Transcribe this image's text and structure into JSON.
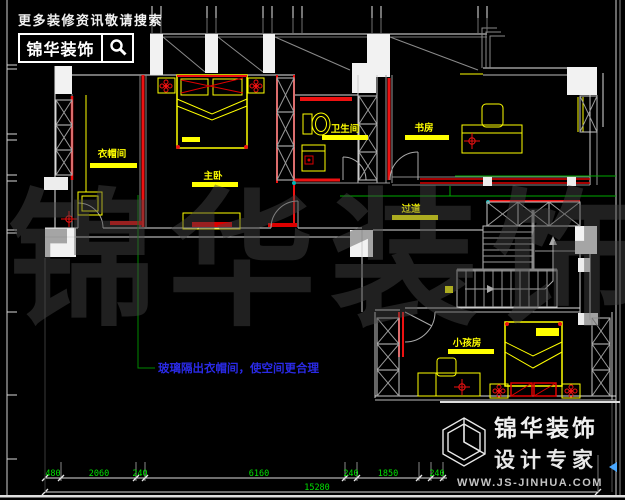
{
  "header": {
    "promo": "更多装修资讯敬请搜索",
    "logo": "锦华装饰"
  },
  "plan": {
    "rooms": [
      {
        "id": "cloakroom",
        "label": "衣帽间"
      },
      {
        "id": "master-bedroom",
        "label": "主卧"
      },
      {
        "id": "bathroom",
        "label": "卫生间"
      },
      {
        "id": "study",
        "label": "书房"
      },
      {
        "id": "corridor",
        "label": "过道"
      },
      {
        "id": "kids-room",
        "label": "小孩房"
      }
    ],
    "annotation": {
      "text": "玻璃隔出衣帽间，使空间更合理"
    }
  },
  "dimensions": {
    "segments": [
      "480",
      "2060",
      "240",
      "6160",
      "240",
      "1850",
      "240"
    ],
    "total": "15280"
  },
  "title_block": {
    "company": "锦华装饰",
    "tagline": "设计专家",
    "website": "WWW.JS-JINHUA.COM"
  },
  "watermark": {
    "chars": [
      "锦",
      "华",
      "装",
      "饰"
    ]
  },
  "colors": {
    "wall_red": "#ee1111",
    "furniture_yellow": "#ffff00",
    "dimension_green": "#00e000",
    "annotation_blue": "#2a2ae6",
    "line_white": "#e8e8e8",
    "watermark_gray": "#1e1e1e",
    "marker_teal": "#00b5b5"
  }
}
